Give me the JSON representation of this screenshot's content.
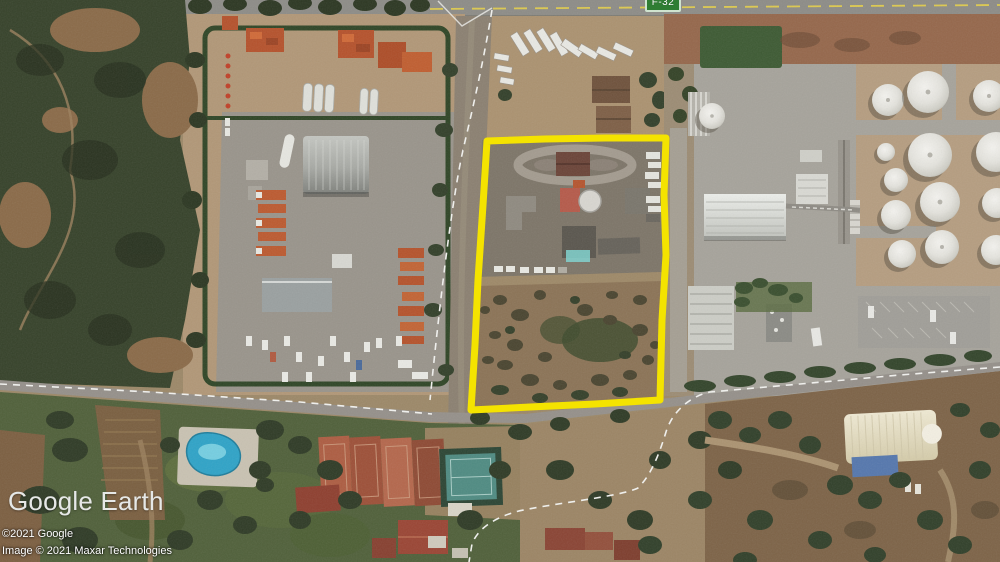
{
  "app": {
    "name": "Google Earth"
  },
  "map_overlay": {
    "road_badge": {
      "label": "F-32",
      "background_color": "#2f7d33",
      "border_color": "#cfe3cf",
      "text_color": "#ffffff"
    },
    "parcel_outline": {
      "color": "#f4e300"
    }
  },
  "watermark": {
    "logo_text": "Google Earth",
    "copyright_line1": "©2021 Google",
    "copyright_line2": "Image © 2021 Maxar Technologies"
  }
}
